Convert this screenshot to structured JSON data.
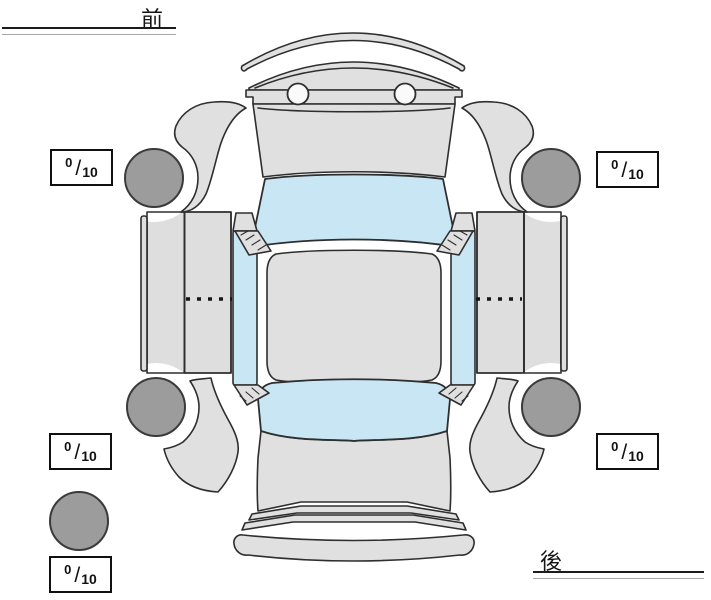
{
  "labels": {
    "front": "前",
    "rear": "後"
  },
  "score_format": {
    "separator": "/"
  },
  "scores": {
    "front_left": {
      "value": "0",
      "max": "10"
    },
    "front_right": {
      "value": "0",
      "max": "10"
    },
    "rear_left": {
      "value": "0",
      "max": "10"
    },
    "rear_right": {
      "value": "0",
      "max": "10"
    },
    "spare": {
      "value": "0",
      "max": "10"
    }
  },
  "diagram": {
    "type": "car-top-view-tire-condition",
    "colors": {
      "body_gray": "#e0e0e0",
      "door_gray": "#dedede",
      "glass_blue": "#c9e6f4",
      "tire_gray": "#9c9c9c",
      "outline": "#2e2e2e",
      "box_border": "#101010"
    }
  }
}
